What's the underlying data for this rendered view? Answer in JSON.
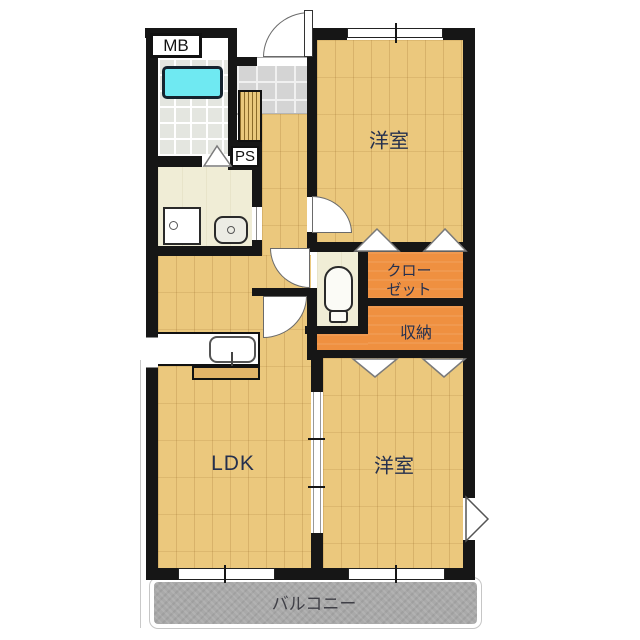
{
  "floorplan": {
    "title": "apartment-floor-plan",
    "labels": {
      "meter_box": "MB",
      "pipe_space": "PS",
      "western_room_top": "洋室",
      "closet_line1": "クロー",
      "closet_line2": "ゼット",
      "storage": "収納",
      "ldk": "LDK",
      "western_room_bottom": "洋室",
      "balcony": "バルコニー"
    },
    "colors": {
      "wall": "#161616",
      "wood_floor": "#ebc87d",
      "washroom_floor": "#f0edd6",
      "bathroom_tile": "#e4e6e0",
      "entry_tile": "#d4d4d4",
      "closet_orange": "#ef9040",
      "bathtub_cyan": "#6fe9f2",
      "balcony_gray": "#a9a9a9",
      "label_navy": "#25304e",
      "balcony_text": "#3f3f46"
    }
  }
}
